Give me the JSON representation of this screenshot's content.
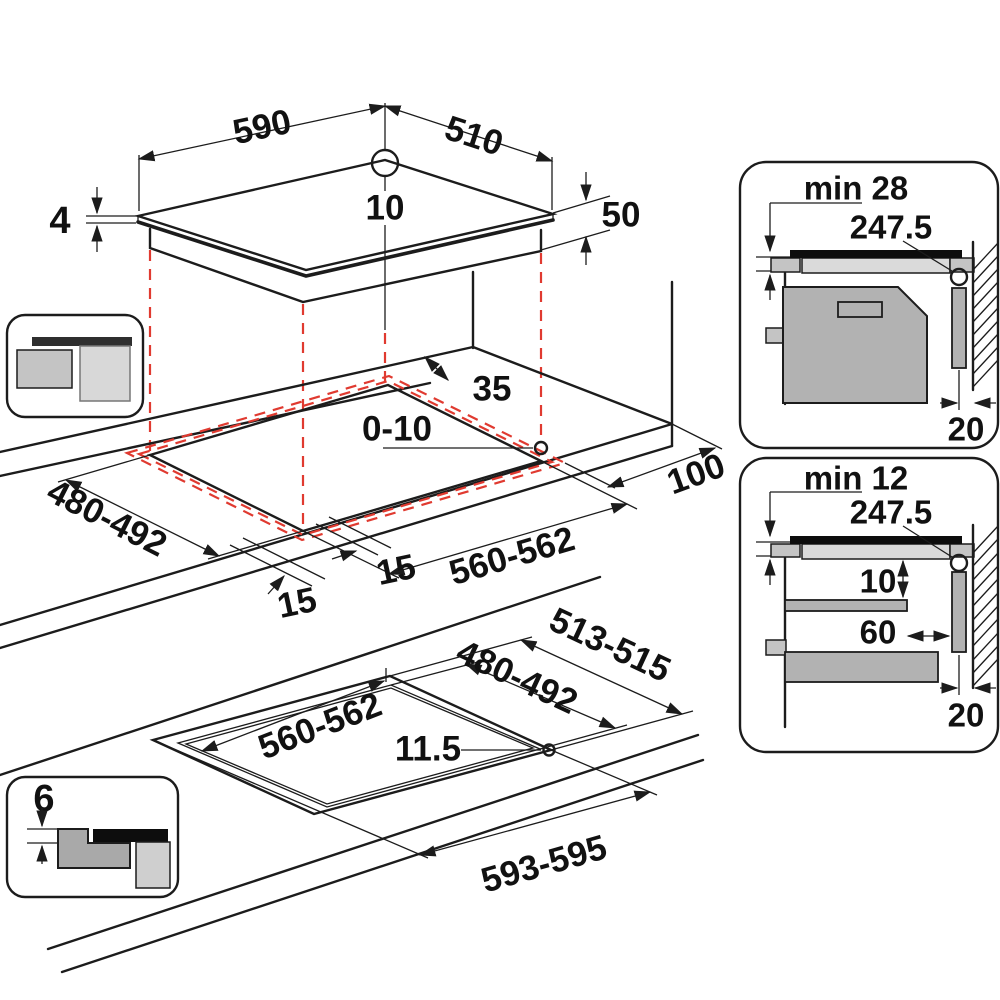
{
  "diagram": {
    "description": "built-in hob installation dimension drawing",
    "colors": {
      "line": "#1c1c1c",
      "projection_red": "#e03a30",
      "panel_gray": "#b2b2b2",
      "glass_black": "#0d0d0d"
    },
    "hob_top": {
      "width": "590",
      "depth": "510",
      "rear_hole": "10",
      "glass_thickness": "4",
      "body_height": "50"
    },
    "worktop_cutout": {
      "rear_clearance": "35",
      "edge_gap": "0-10",
      "cutout_depth": "480-492",
      "cutout_width": "560-562",
      "overhang_side": "15",
      "overhang_front": "15",
      "right_clearance": "100"
    },
    "flush_cutout": {
      "recess_depth": "513-515",
      "inner_depth": "480-492",
      "inner_width": "560-562",
      "corner_radius": "11.5",
      "recess_width": "593-595"
    },
    "clearance_oven_inset": {
      "min_label": "min 28",
      "fixing_offset": "247.5",
      "wall_gap": "20"
    },
    "clearance_shelf_inset": {
      "min_label": "min 12",
      "fixing_offset": "247.5",
      "shelf_clearance": "10",
      "shelf_setback": "60",
      "wall_gap": "20"
    },
    "flush_step_inset": {
      "step_depth": "6"
    }
  }
}
